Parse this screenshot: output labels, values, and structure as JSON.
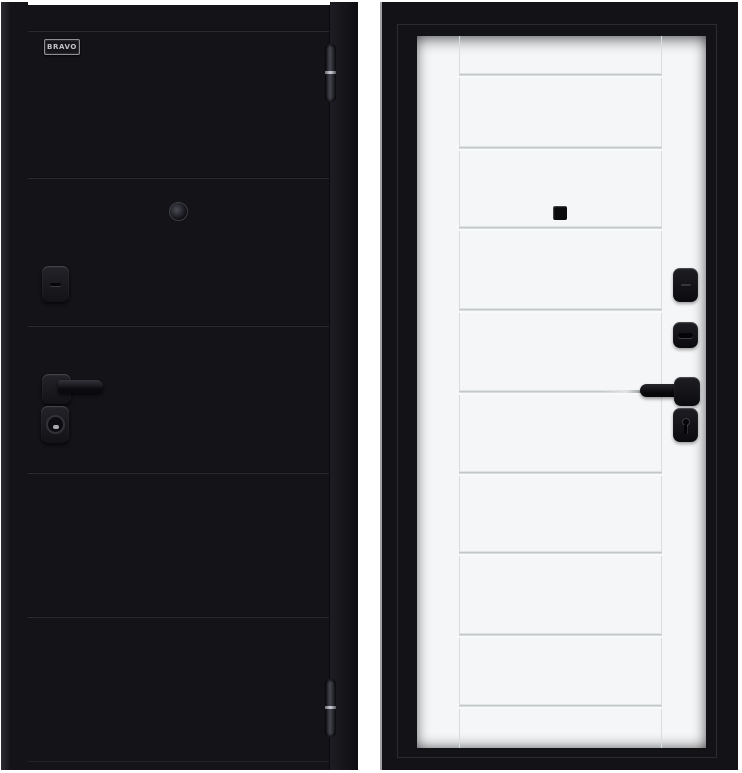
{
  "product": {
    "brand": "BRAVO",
    "description": "Steel entry door shown from both sides: black exterior panel and white interior panel in a black frame",
    "colors": {
      "background": "#ffffff",
      "exterior_leaf": "#131318",
      "interior_leaf": "#f4f6f7",
      "frame": "#131317",
      "hardware": "#0c0c0f",
      "panel_line": "#bcc2c4",
      "hinge_metal": "#45454f"
    }
  }
}
